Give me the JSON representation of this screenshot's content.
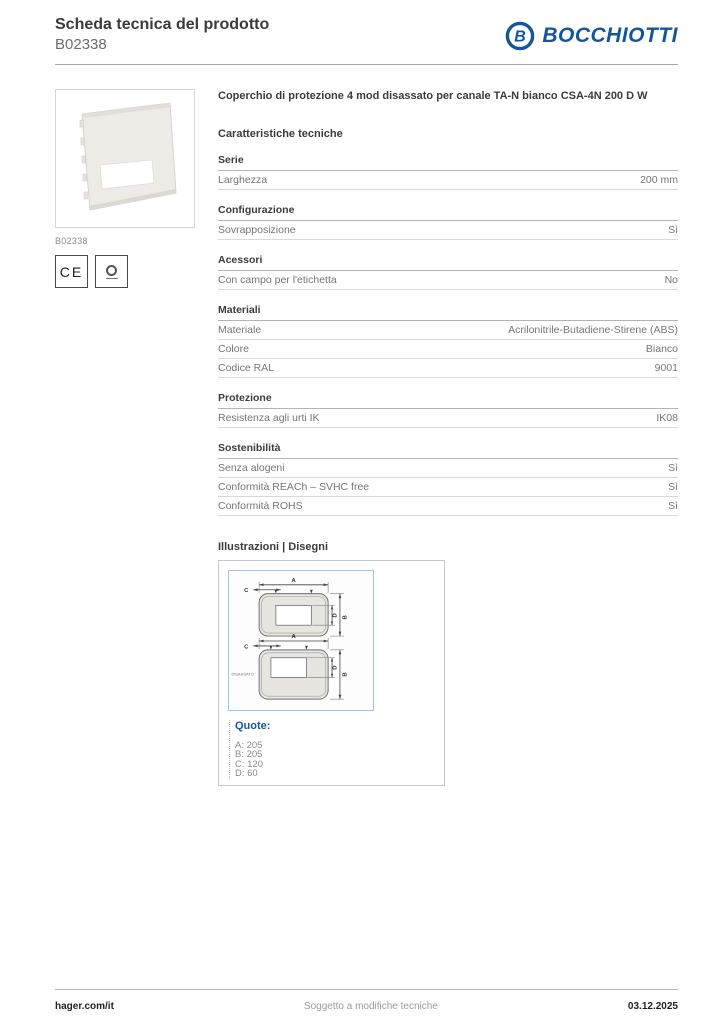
{
  "header": {
    "title": "Scheda tecnica del prodotto",
    "code": "B02338",
    "brand": "BOCCHIOTTI",
    "brand_initial": "B"
  },
  "product": {
    "image_caption": "B02338",
    "ce_mark": "CE",
    "name": "Coperchio di protezione 4 mod disassato per canale TA-N bianco CSA-4N 200 D W"
  },
  "characteristics": {
    "heading": "Caratteristiche tecniche",
    "sections": [
      {
        "title": "Serie",
        "rows": [
          {
            "label": "Larghezza",
            "value": "200 mm"
          }
        ]
      },
      {
        "title": "Configurazione",
        "rows": [
          {
            "label": "Sovrapposizione",
            "value": "Sì"
          }
        ]
      },
      {
        "title": "Acessori",
        "rows": [
          {
            "label": "Con campo per l'etichetta",
            "value": "No"
          }
        ]
      },
      {
        "title": "Materiali",
        "rows": [
          {
            "label": "Materiale",
            "value": "Acrilonitrile-Butadiene-Stirene (ABS)"
          },
          {
            "label": "Colore",
            "value": "Bianco"
          },
          {
            "label": "Codice RAL",
            "value": "9001"
          }
        ]
      },
      {
        "title": "Protezione",
        "rows": [
          {
            "label": "Resistenza agli urti IK",
            "value": "IK08"
          }
        ]
      },
      {
        "title": "Sostenibilità",
        "rows": [
          {
            "label": "Senza alogeni",
            "value": "Sì"
          },
          {
            "label": "Conformità REACh – SVHC free",
            "value": "Sì"
          },
          {
            "label": "Conformità ROHS",
            "value": "Sì"
          }
        ]
      }
    ]
  },
  "illustrations": {
    "heading": "Illustrazioni | Disegni",
    "dim_letters": {
      "a": "A",
      "b": "B",
      "c": "C",
      "d": "D"
    },
    "drawing_label": "DISASSATO",
    "quote": {
      "label": "Quote:",
      "items": [
        "A: 205",
        "B: 205",
        "C: 120",
        "D: 60"
      ]
    }
  },
  "footer": {
    "website": "hager.com/it",
    "disclaimer": "Soggetto a modifiche tecniche",
    "date": "03.12.2025"
  },
  "colors": {
    "brand_blue": "#14569d",
    "drawing_border_blue": "#9fc6da"
  }
}
